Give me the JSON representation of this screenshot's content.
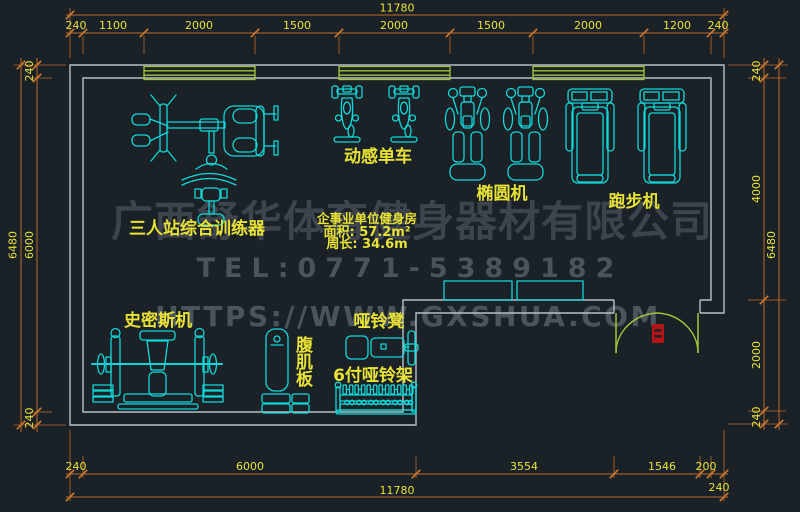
{
  "room": {
    "title": "企事业单位健身房",
    "area": "面积: 57.2m²",
    "perimeter": "周长: 34.6m"
  },
  "watermark": {
    "company": "广西舒华体育健身器材有限公司",
    "tel": "TEL:0771-5389182",
    "url": "HTTPS://WWW.GXSHUA.COM"
  },
  "labels": {
    "spin_bike": "动感单车",
    "elliptical": "椭圆机",
    "treadmill": "跑步机",
    "multi_station": "三人站综合训练器",
    "smith": "史密斯机",
    "ab_board": "腹肌板",
    "dumbbell_bench": "哑铃凳",
    "dumbbell_rack": "6付哑铃架"
  },
  "dims": {
    "top": {
      "overall": "11780",
      "segments": [
        "240",
        "1100",
        "2000",
        "1500",
        "2000",
        "1500",
        "2000",
        "1200",
        "240"
      ]
    },
    "bottom": {
      "overall": "11780",
      "segments": [
        "240",
        "6000",
        "3554",
        "1546",
        "200"
      ],
      "wall_offset": "240"
    },
    "left": {
      "overall": "6480",
      "segments": [
        "240",
        "6000",
        "240"
      ]
    },
    "right": {
      "overall": "6480",
      "segments": [
        "240",
        "4000",
        "2000",
        "240"
      ]
    }
  },
  "colors": {
    "background": "#1a2127",
    "equipment": "#0fd8d8",
    "text_yellow": "#e8e234",
    "dimension_line": "#c06a28",
    "wall": "#b9bfc7",
    "window_door": "#a6c23a",
    "door_marker": "#b41616",
    "watermark_dark": "#3d444d",
    "watermark_light": "#4b535c"
  }
}
